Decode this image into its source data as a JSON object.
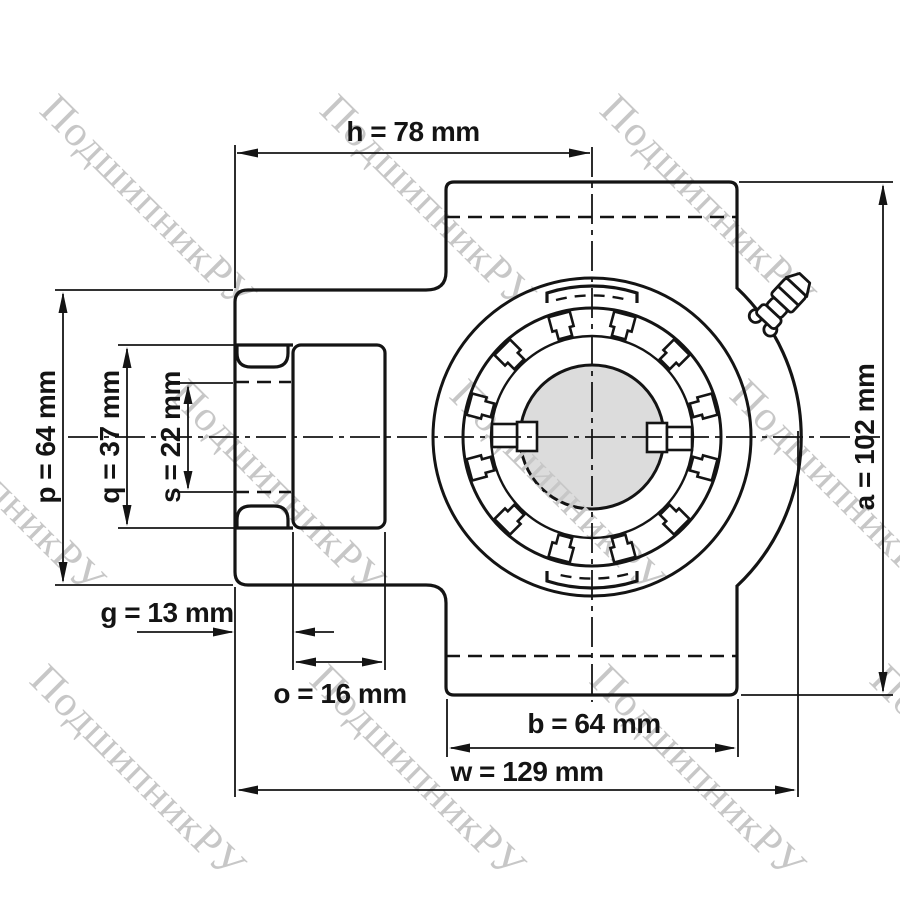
{
  "drawing": {
    "description": "Take-up bearing housing unit, dimensioned front view",
    "unit": "mm"
  },
  "watermark": {
    "text": "ПодшипникРУ",
    "color": "#c7c7c7"
  },
  "colors": {
    "line": "#141414",
    "bore_fill": "#dcdcdc",
    "background": "#ffffff",
    "watermark": "#c7c7c7"
  },
  "dims": {
    "h": {
      "param": "h",
      "value": 78,
      "unit": "mm",
      "label": "h = 78 mm"
    },
    "a": {
      "param": "a",
      "value": 102,
      "unit": "mm",
      "label": "a = 102 mm"
    },
    "p": {
      "param": "p",
      "value": 64,
      "unit": "mm",
      "label": "p = 64 mm"
    },
    "q": {
      "param": "q",
      "value": 37,
      "unit": "mm",
      "label": "q = 37 mm"
    },
    "s": {
      "param": "s",
      "value": 22,
      "unit": "mm",
      "label": "s = 22 mm"
    },
    "g": {
      "param": "g",
      "value": 13,
      "unit": "mm",
      "label": "g = 13 mm"
    },
    "o": {
      "param": "o",
      "value": 16,
      "unit": "mm",
      "label": "o = 16 mm"
    },
    "b": {
      "param": "b",
      "value": 64,
      "unit": "mm",
      "label": "b = 64 mm"
    },
    "w": {
      "param": "w",
      "value": 129,
      "unit": "mm",
      "label": "w = 129 mm"
    }
  }
}
